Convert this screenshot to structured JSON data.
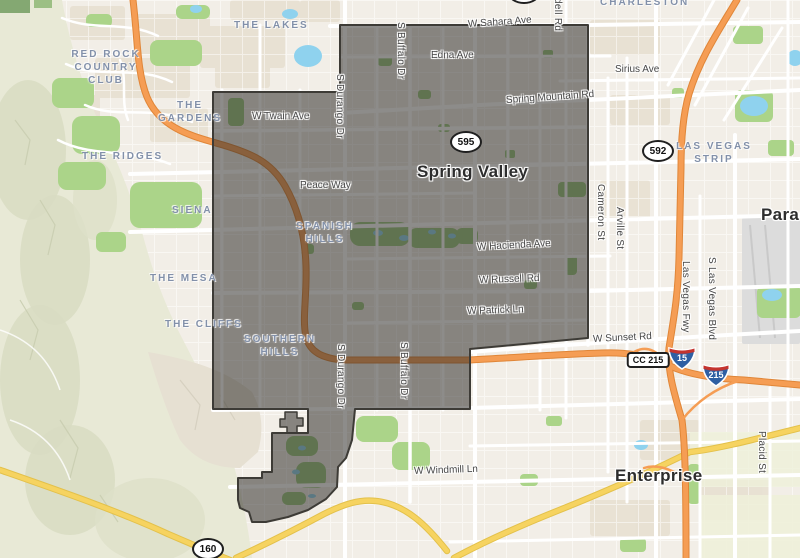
{
  "map": {
    "cities": {
      "spring_valley": "Spring Valley",
      "paradise": "Paradise",
      "enterprise": "Enterprise"
    },
    "neighborhoods": {
      "the_lakes": "THE LAKES",
      "charleston": "CHARLESTON",
      "red_rock_country_club": "RED ROCK COUNTRY CLUB",
      "the_gardens": "THE GARDENS",
      "the_ridges": "THE RIDGES",
      "siena": "SIENA",
      "the_mesa": "THE MESA",
      "the_cliffs": "THE CLIFFS",
      "spanish_hills": "SPANISH HILLS",
      "southern_hills": "SOUTHERN HILLS",
      "las_vegas_strip": "LAS VEGAS STRIP"
    },
    "streets": {
      "w_sahara_ave": "W Sahara Ave",
      "edna_ave": "Edna Ave",
      "spring_mountain_rd": "Spring Mountain Rd",
      "w_twain_ave": "W Twain Ave",
      "sirius_ave": "Sirius Ave",
      "peace_way": "Peace Way",
      "w_hacienda_ave": "W Hacienda Ave",
      "w_russell_rd": "W Russell Rd",
      "w_patrick_ln": "W Patrick Ln",
      "w_sunset_rd": "W Sunset Rd",
      "w_windmill_ln": "W Windmill Ln",
      "s_buffalo_dr": "S Buffalo Dr",
      "s_durango_dr": "S Durango Dr",
      "cameron_st": "Cameron St",
      "arville_st": "Arville St",
      "lindell_rd_partial": "dell Rd",
      "las_vegas_fwy": "Las Vegas Fwy",
      "s_las_vegas_blvd": "S Las Vegas Blvd",
      "placid_st": "Placid St"
    },
    "route_shields": {
      "nv_595": "595",
      "nv_592": "592",
      "nv_160": "160",
      "i_15": "15",
      "i_215": "215",
      "cc_215": "CC 215"
    },
    "colors": {
      "boundary_fill": "rgba(48,46,42,0.55)",
      "boundary_stroke": "#3d3b36",
      "freeway_orange": "#f59d54",
      "route_yellow": "#f6d360",
      "park_green": "#abd489",
      "water_blue": "#8fd2ee",
      "desert": "#e8e9d6",
      "urban_base": "#f2eee7"
    }
  }
}
